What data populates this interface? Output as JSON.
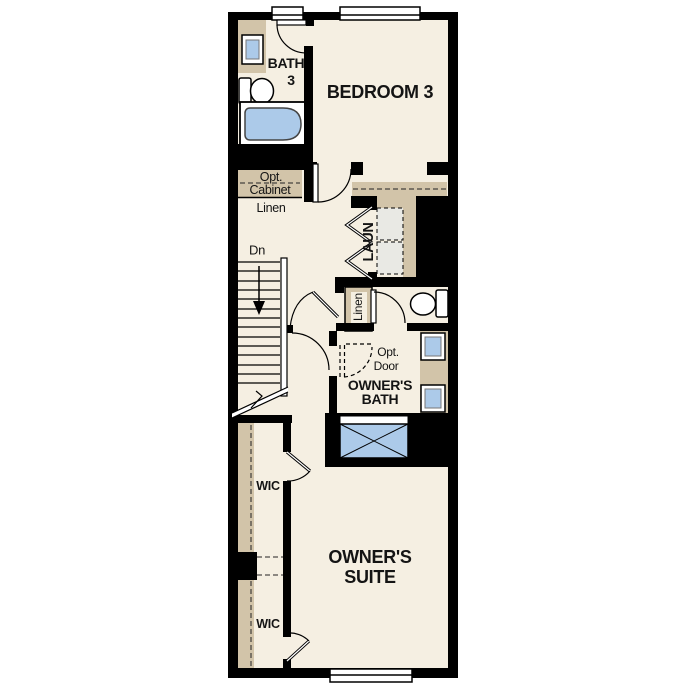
{
  "colors": {
    "background": "#ffffff",
    "floor": "#f5efe2",
    "walls": "#000000",
    "casework_tan": "#d2c4a9",
    "fixture_blue": "#accae9",
    "appliance_gray": "#e9e9e4"
  },
  "labels": {
    "bath3_line1": "BATH",
    "bath3_line2": "3",
    "bedroom3": "BEDROOM 3",
    "opt_cabinet_line1": "Opt.",
    "opt_cabinet_line2": "Cabinet",
    "linen_shelf": "Linen",
    "stairs_direction": "Dn",
    "laundry": "LAUN",
    "linen_closet": "Linen",
    "opt_door_line1": "Opt.",
    "opt_door_line2": "Door",
    "owners_bath_line1": "OWNER'S",
    "owners_bath_line2": "BATH",
    "wic_upper": "WIC",
    "wic_lower": "WIC",
    "owners_suite_line1": "OWNER'S",
    "owners_suite_line2": "SUITE"
  }
}
